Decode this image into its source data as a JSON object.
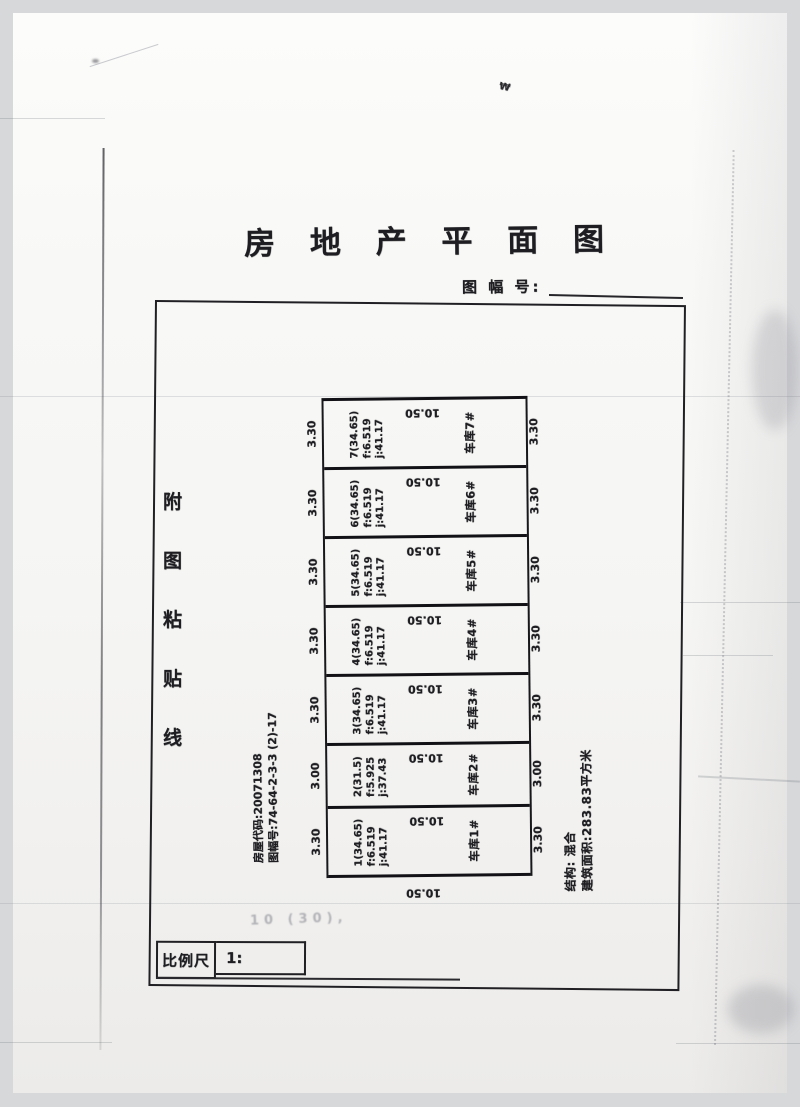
{
  "header": {
    "title": "房 地 产 平 面 图",
    "sheet_no_label": "图 幅 号:",
    "sheet_no_value": ""
  },
  "paste_line": "附图粘贴线",
  "meta": {
    "house_code": "房屋代码:20071308",
    "sheet_code": "图幅号:74-64-2-3-3 (2)-17"
  },
  "plan": {
    "bottom_dim": "10.50",
    "units": [
      {
        "name": "车库7#",
        "area": "7(34.65)",
        "f": "f:6.519",
        "j": "j:41.17",
        "width_dim": "3.30",
        "depth_dim": "10.50"
      },
      {
        "name": "车库6#",
        "area": "6(34.65)",
        "f": "f:6.519",
        "j": "j:41.17",
        "width_dim": "3.30",
        "depth_dim": "10.50"
      },
      {
        "name": "车库5#",
        "area": "5(34.65)",
        "f": "f:6.519",
        "j": "j:41.17",
        "width_dim": "3.30",
        "depth_dim": "10.50"
      },
      {
        "name": "车库4#",
        "area": "4(34.65)",
        "f": "f:6.519",
        "j": "j:41.17",
        "width_dim": "3.30",
        "depth_dim": "10.50"
      },
      {
        "name": "车库3#",
        "area": "3(34.65)",
        "f": "f:6.519",
        "j": "j:41.17",
        "width_dim": "3.30",
        "depth_dim": "10.50"
      },
      {
        "name": "车库2#",
        "area": "2(31.5)",
        "f": "f:5.925",
        "j": "j:37.43",
        "width_dim": "3.00",
        "depth_dim": "10.50"
      },
      {
        "name": "车库1#",
        "area": "1(34.65)",
        "f": "f:6.519",
        "j": "j:41.17",
        "width_dim": "3.30",
        "depth_dim": "10.50"
      }
    ]
  },
  "summary": {
    "structure": "结构: 混合",
    "area_total": "建筑面积:283.83平方米"
  },
  "scale_bar": {
    "label": "比例尺",
    "value": "1:"
  },
  "artifacts": {
    "faint_note": "10 (30),",
    "top_mark": "₩"
  }
}
